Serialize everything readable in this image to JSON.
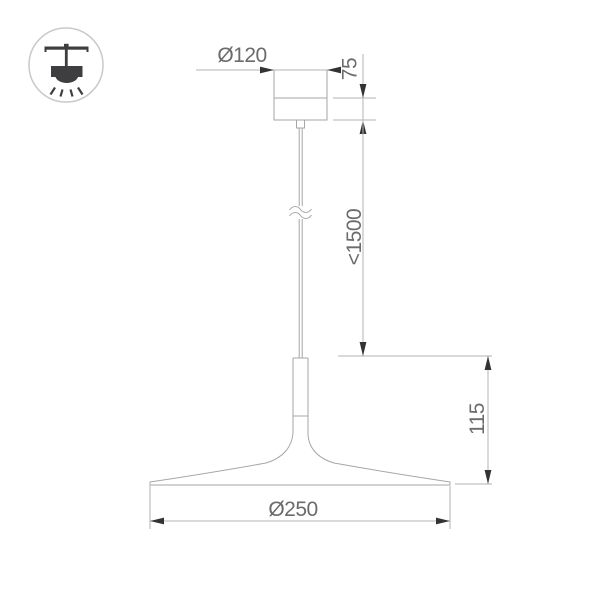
{
  "page": {
    "background": "#ffffff",
    "kind": "technical dimension drawing of a pendant lamp"
  },
  "icon": {
    "type": "pendant-ceiling-lamp",
    "colors": {
      "glyph": "#3e3e40",
      "circle_stroke": "#c9c9c9"
    }
  },
  "drawing": {
    "object": "pendant lamp with flat cone shade",
    "labels": {
      "canopy_diameter": "Ø120",
      "canopy_height": "75",
      "suspension_length": "<1500",
      "shade_height": "115",
      "shade_diameter": "Ø250"
    },
    "colors": {
      "outline": "#a6a6a6",
      "dimension_line": "#b3b3b3",
      "arrow": "#333333",
      "text": "#6b6b6b"
    }
  }
}
